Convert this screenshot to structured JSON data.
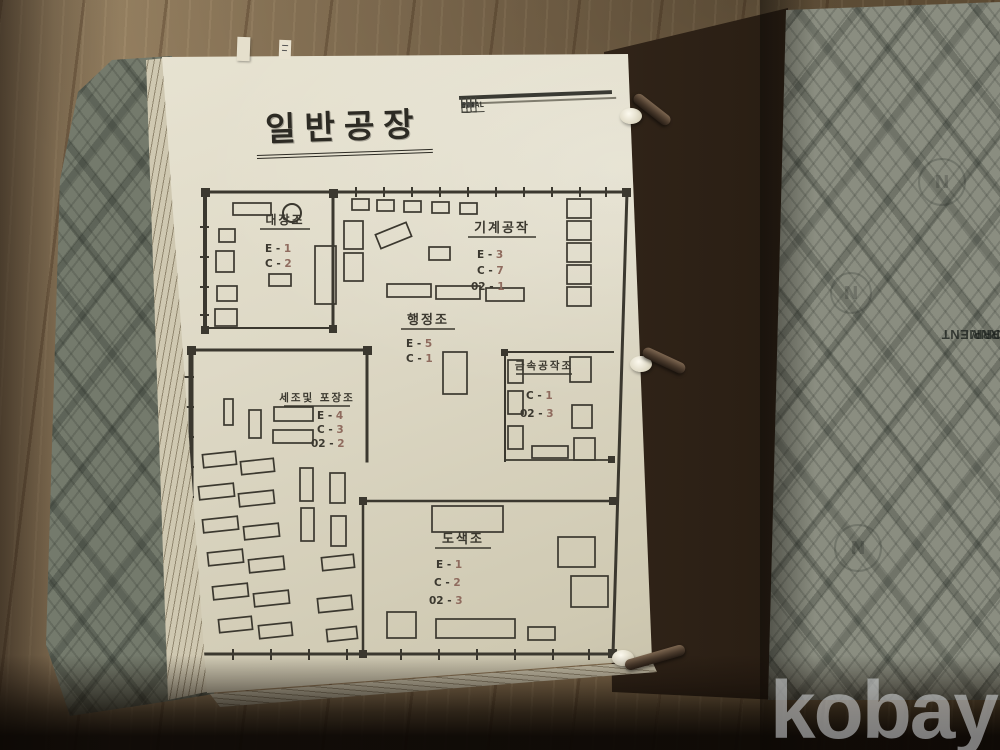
{
  "photo": {
    "watermark": "kobay",
    "stamp": {
      "line1": "SE LEAF CORP.",
      "line2": "U. S. GOVERNMENT"
    },
    "emblem_letter": "N"
  },
  "page": {
    "title": "일반공장",
    "summary_table": {
      "headers": [
        "",
        "O",
        "E",
        "C",
        "0.2",
        "TOTAL"
      ],
      "rows": [
        {
          "label": "A/S",
          "values": [
            "1",
            "20",
            "18",
            "14",
            "63"
          ]
        },
        {
          "label": "P/o",
          "values": [
            "",
            "20",
            "19",
            "14",
            "53"
          ]
        },
        {
          "label": "o/s",
          "values": [
            "-1",
            "",
            "",
            "",
            "-10"
          ]
        }
      ]
    }
  },
  "floor_plan": {
    "ink": "#3b382f",
    "value_ink": "#8f6b5e",
    "walls": [
      [
        205,
        192,
        627,
        192,
        3
      ],
      [
        627,
        192,
        613,
        654,
        3
      ],
      [
        190,
        654,
        613,
        654,
        3
      ],
      [
        205,
        192,
        205,
        331,
        4
      ],
      [
        333,
        193,
        333,
        330,
        3
      ],
      [
        205,
        328,
        333,
        328,
        2
      ],
      [
        191,
        349,
        191,
        655,
        5
      ],
      [
        191,
        350,
        367,
        350,
        3
      ],
      [
        367,
        350,
        367,
        461,
        3
      ],
      [
        363,
        501,
        363,
        654,
        2.5
      ],
      [
        505,
        352,
        613,
        352,
        2
      ],
      [
        505,
        352,
        505,
        461,
        2
      ],
      [
        505,
        460,
        613,
        460,
        1.8
      ],
      [
        363,
        501,
        613,
        501,
        2.5
      ]
    ],
    "ticks": [
      [
        355,
        187,
        2,
        10
      ],
      [
        383,
        187,
        2,
        10
      ],
      [
        411,
        187,
        2,
        10
      ],
      [
        439,
        187,
        2,
        10
      ],
      [
        467,
        187,
        2,
        10
      ],
      [
        495,
        187,
        2,
        10
      ],
      [
        523,
        187,
        2,
        10
      ],
      [
        551,
        187,
        2,
        10
      ],
      [
        579,
        187,
        2,
        10
      ],
      [
        605,
        187,
        2,
        10
      ],
      [
        232,
        649,
        2,
        11
      ],
      [
        270,
        649,
        2,
        11
      ],
      [
        308,
        649,
        2,
        11
      ],
      [
        346,
        649,
        2,
        11
      ],
      [
        400,
        649,
        2,
        11
      ],
      [
        438,
        649,
        2,
        11
      ],
      [
        476,
        649,
        2,
        11
      ],
      [
        514,
        649,
        2,
        11
      ],
      [
        552,
        649,
        2,
        11
      ],
      [
        588,
        649,
        2,
        11
      ],
      [
        184,
        376,
        10,
        2
      ],
      [
        184,
        406,
        10,
        2
      ],
      [
        184,
        436,
        10,
        2
      ],
      [
        184,
        466,
        10,
        2
      ],
      [
        184,
        496,
        10,
        2
      ],
      [
        184,
        526,
        10,
        2
      ],
      [
        184,
        556,
        10,
        2
      ],
      [
        184,
        586,
        10,
        2
      ],
      [
        184,
        616,
        10,
        2
      ],
      [
        184,
        642,
        10,
        2
      ],
      [
        200,
        226,
        9,
        2
      ],
      [
        200,
        256,
        9,
        2
      ],
      [
        200,
        286,
        9,
        2
      ],
      [
        200,
        314,
        9,
        2
      ]
    ],
    "columns": [
      [
        201,
        188,
        9
      ],
      [
        329,
        189,
        9
      ],
      [
        622,
        188,
        9
      ],
      [
        201,
        326,
        8
      ],
      [
        329,
        325,
        8
      ],
      [
        187,
        346,
        9
      ],
      [
        363,
        346,
        9
      ],
      [
        187,
        650,
        9
      ],
      [
        359,
        650,
        8
      ],
      [
        608,
        649,
        9
      ],
      [
        608,
        456,
        7
      ],
      [
        501,
        349,
        7
      ],
      [
        359,
        497,
        8
      ],
      [
        609,
        497,
        8
      ]
    ],
    "circles": [
      {
        "cx": 292,
        "cy": 213,
        "r": 9
      }
    ],
    "furniture": [
      [
        233,
        203,
        38,
        12,
        0
      ],
      [
        219,
        229,
        16,
        13,
        0
      ],
      [
        216,
        251,
        18,
        21,
        0
      ],
      [
        217,
        286,
        20,
        15,
        0
      ],
      [
        215,
        309,
        22,
        17,
        0
      ],
      [
        315,
        246,
        21,
        58,
        0
      ],
      [
        269,
        274,
        22,
        12,
        0
      ],
      [
        352,
        199,
        17,
        11,
        0
      ],
      [
        377,
        200,
        17,
        11,
        0
      ],
      [
        404,
        201,
        17,
        11,
        0
      ],
      [
        432,
        202,
        17,
        11,
        0
      ],
      [
        460,
        203,
        17,
        11,
        0
      ],
      [
        567,
        199,
        24,
        19,
        0
      ],
      [
        567,
        221,
        24,
        19,
        0
      ],
      [
        567,
        243,
        24,
        19,
        0
      ],
      [
        567,
        265,
        24,
        19,
        0
      ],
      [
        567,
        287,
        24,
        19,
        0
      ],
      [
        344,
        221,
        19,
        28,
        0
      ],
      [
        344,
        253,
        19,
        28,
        0
      ],
      [
        377,
        228,
        33,
        15,
        -22
      ],
      [
        429,
        247,
        21,
        13,
        0
      ],
      [
        387,
        284,
        44,
        13,
        0
      ],
      [
        436,
        286,
        44,
        13,
        0
      ],
      [
        486,
        288,
        38,
        13,
        0
      ],
      [
        443,
        352,
        24,
        42,
        0
      ],
      [
        508,
        360,
        15,
        23,
        0
      ],
      [
        508,
        391,
        15,
        23,
        0
      ],
      [
        508,
        426,
        15,
        23,
        0
      ],
      [
        570,
        357,
        21,
        25,
        0
      ],
      [
        572,
        405,
        20,
        23,
        0
      ],
      [
        574,
        438,
        21,
        22,
        0
      ],
      [
        532,
        446,
        36,
        12,
        0
      ],
      [
        274,
        407,
        39,
        14,
        0
      ],
      [
        273,
        430,
        40,
        13,
        0
      ],
      [
        224,
        399,
        9,
        26,
        0
      ],
      [
        249,
        410,
        12,
        28,
        0
      ],
      [
        203,
        453,
        33,
        13,
        -6
      ],
      [
        241,
        460,
        33,
        13,
        -6
      ],
      [
        199,
        485,
        35,
        13,
        -6
      ],
      [
        239,
        492,
        35,
        13,
        -6
      ],
      [
        203,
        518,
        35,
        13,
        -6
      ],
      [
        244,
        525,
        35,
        13,
        -6
      ],
      [
        208,
        551,
        35,
        13,
        -6
      ],
      [
        249,
        558,
        35,
        13,
        -6
      ],
      [
        213,
        585,
        35,
        13,
        -6
      ],
      [
        254,
        592,
        35,
        13,
        -6
      ],
      [
        219,
        618,
        33,
        13,
        -6
      ],
      [
        259,
        624,
        33,
        13,
        -6
      ],
      [
        300,
        468,
        13,
        33,
        0
      ],
      [
        301,
        508,
        13,
        33,
        0
      ],
      [
        330,
        473,
        15,
        30,
        0
      ],
      [
        331,
        516,
        15,
        30,
        0
      ],
      [
        322,
        556,
        32,
        13,
        -6
      ],
      [
        318,
        597,
        34,
        14,
        -6
      ],
      [
        327,
        628,
        30,
        12,
        -6
      ],
      [
        432,
        506,
        71,
        26,
        0
      ],
      [
        558,
        537,
        37,
        30,
        0
      ],
      [
        571,
        576,
        37,
        31,
        0
      ],
      [
        387,
        612,
        29,
        26,
        0
      ],
      [
        436,
        619,
        79,
        19,
        0
      ],
      [
        528,
        627,
        27,
        13,
        0
      ]
    ],
    "rooms": [
      {
        "name": "대장조",
        "cx": 285,
        "y": 224,
        "fs": 12,
        "uw": 50,
        "stats": [
          {
            "k": "E",
            "v": "1",
            "x": 265,
            "y": 252
          },
          {
            "k": "C",
            "v": "2",
            "x": 265,
            "y": 267
          }
        ]
      },
      {
        "name": "기계공작",
        "cx": 502,
        "y": 232,
        "fs": 13,
        "uw": 68,
        "stats": [
          {
            "k": "E",
            "v": "3",
            "x": 477,
            "y": 258
          },
          {
            "k": "C",
            "v": "7",
            "x": 477,
            "y": 274
          },
          {
            "k": "02",
            "v": "1",
            "x": 471,
            "y": 290
          }
        ]
      },
      {
        "name": "행정조",
        "cx": 428,
        "y": 324,
        "fs": 13,
        "uw": 54,
        "stats": [
          {
            "k": "E",
            "v": "5",
            "x": 406,
            "y": 347
          },
          {
            "k": "C",
            "v": "1",
            "x": 406,
            "y": 362
          }
        ]
      },
      {
        "name": "금속공작조",
        "cx": 544,
        "y": 369,
        "fs": 10.5,
        "uw": 56,
        "stats": [
          {
            "k": "C",
            "v": "1",
            "x": 526,
            "y": 399
          },
          {
            "k": "02",
            "v": "3",
            "x": 520,
            "y": 417
          }
        ]
      },
      {
        "name": "세조및 포장조",
        "cx": 317,
        "y": 401,
        "fs": 10.5,
        "uw": 66,
        "stats": [
          {
            "k": "E",
            "v": "4",
            "x": 317,
            "y": 419
          },
          {
            "k": "C",
            "v": "3",
            "x": 317,
            "y": 433
          },
          {
            "k": "02",
            "v": "2",
            "x": 311,
            "y": 447
          }
        ]
      },
      {
        "name": "도색조",
        "cx": 463,
        "y": 543,
        "fs": 13,
        "uw": 56,
        "stats": [
          {
            "k": "E",
            "v": "1",
            "x": 436,
            "y": 568
          },
          {
            "k": "C",
            "v": "2",
            "x": 434,
            "y": 586
          },
          {
            "k": "02",
            "v": "3",
            "x": 429,
            "y": 604
          }
        ]
      }
    ]
  }
}
